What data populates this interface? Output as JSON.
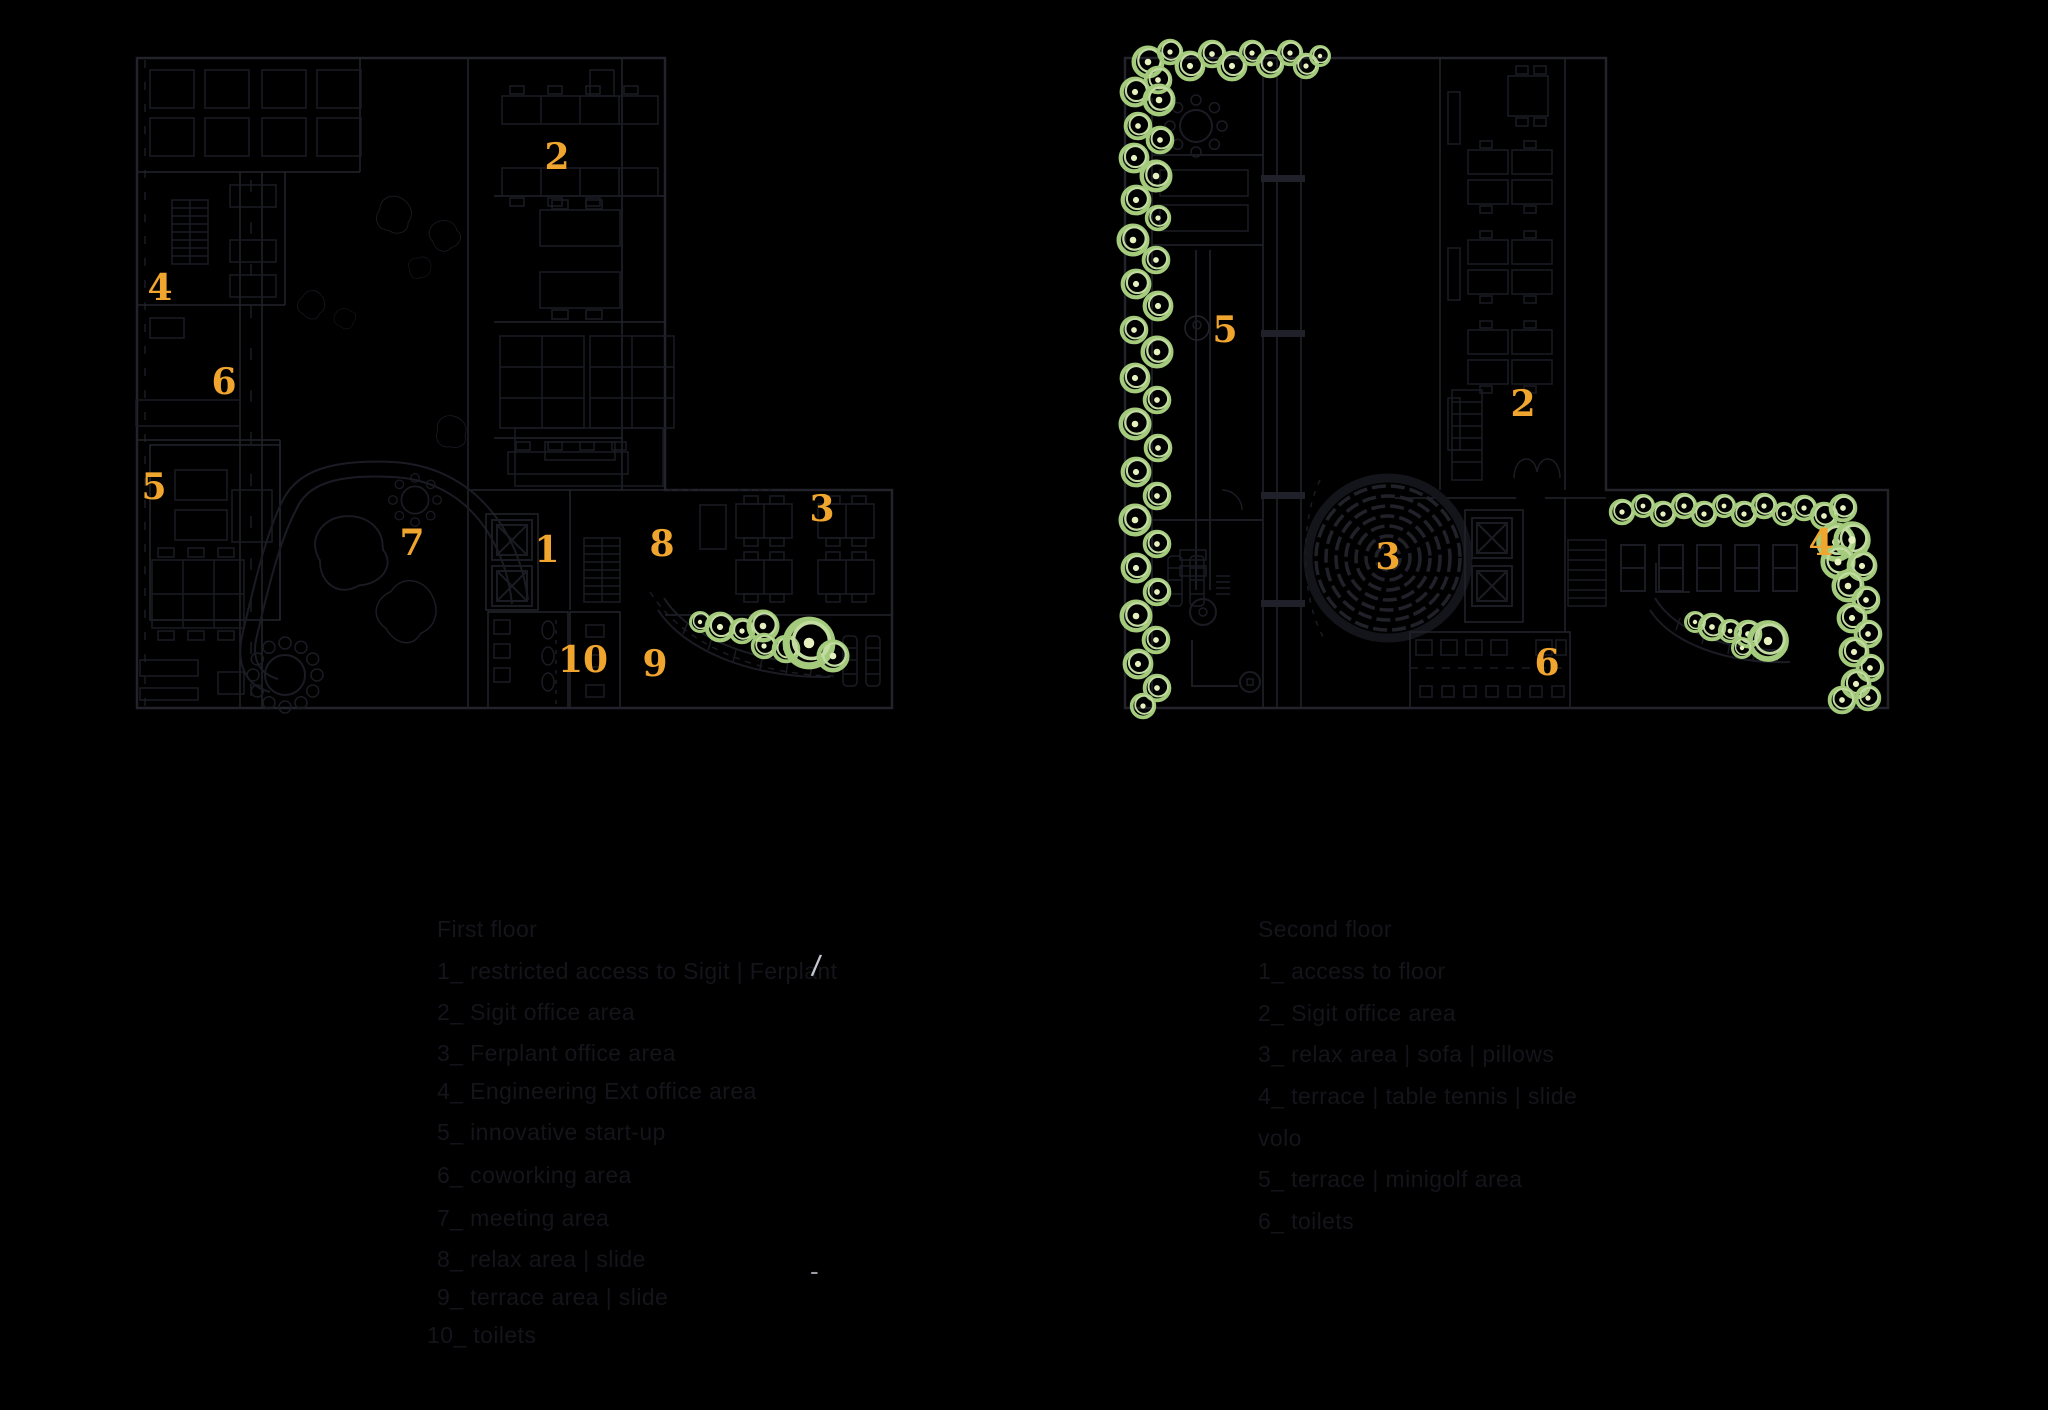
{
  "colors": {
    "background": "#000000",
    "plan_line": "#23232c",
    "furniture_line": "#1b1b24",
    "tree_green": "#a3cb7b",
    "tree_highlight": "#c1dba0",
    "tree_center": "#e7f1bf",
    "number_orange": "#f0a52e",
    "legend_text": "#14141a",
    "cursor_gray": "#c4c6cf"
  },
  "floor1": {
    "area_labels": [
      {
        "n": "2",
        "x": 557,
        "y": 157
      },
      {
        "n": "4",
        "x": 160,
        "y": 288
      },
      {
        "n": "6",
        "x": 224,
        "y": 382
      },
      {
        "n": "5",
        "x": 154,
        "y": 487
      },
      {
        "n": "7",
        "x": 412,
        "y": 543
      },
      {
        "n": "1",
        "x": 547,
        "y": 550
      },
      {
        "n": "8",
        "x": 662,
        "y": 544
      },
      {
        "n": "3",
        "x": 822,
        "y": 509
      },
      {
        "n": "10",
        "x": 583,
        "y": 660
      },
      {
        "n": "9",
        "x": 655,
        "y": 664
      }
    ],
    "legend": {
      "title": "First floor",
      "items": [
        "1_ restricted access to Sigit | Ferplant",
        "2_ Sigit office area",
        "3_ Ferplant office area",
        "4_ Engineering Ext office area",
        "5_ innovative start-up",
        "6_ coworking area",
        "7_ meeting area",
        "8_ relax area | slide",
        "9_ terrace area | slide",
        "10_ toilets"
      ]
    }
  },
  "floor2": {
    "area_labels": [
      {
        "n": "5",
        "x": 1225,
        "y": 330
      },
      {
        "n": "2",
        "x": 1523,
        "y": 404
      },
      {
        "n": "3",
        "x": 1388,
        "y": 557
      },
      {
        "n": "4",
        "x": 1821,
        "y": 543
      },
      {
        "n": "6",
        "x": 1547,
        "y": 663
      }
    ],
    "legend": {
      "title": "Second floor",
      "items": [
        "1_ access to floor",
        "2_ Sigit office area",
        "3_ relax area | sofa | pillows",
        "4_ terrace | table tennis | slide",
        "volo",
        "5_ terrace | minigolf area",
        "6_ toilets"
      ]
    }
  },
  "marks": {
    "slash": "/",
    "dash": "-"
  }
}
